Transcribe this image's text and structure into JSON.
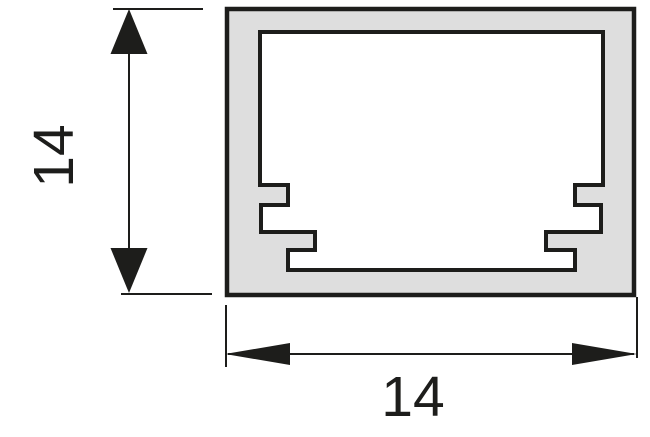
{
  "diagram": {
    "type": "technical-drawing-cross-section",
    "subject": "square channel profile cross-section with inner mounting grooves",
    "labels": {
      "height_dimension": "14",
      "width_dimension": "14"
    },
    "colors": {
      "background": "#ffffff",
      "profile_fill": "#dedede",
      "cavity_fill": "#ffffff",
      "line": "#1d1d1b"
    }
  }
}
